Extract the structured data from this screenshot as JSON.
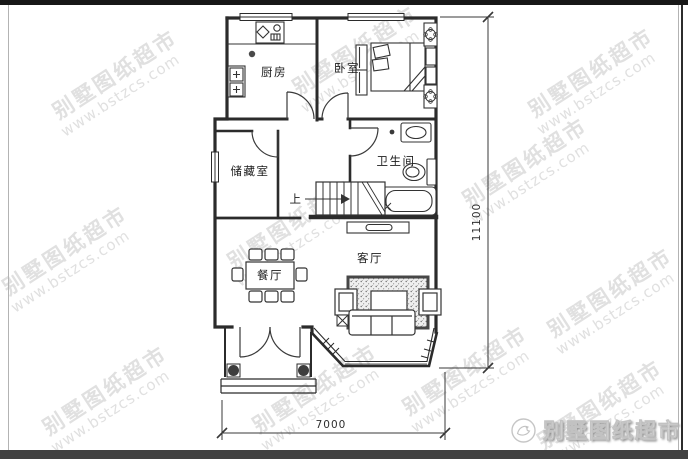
{
  "watermark": {
    "line1": "别墅图纸超市",
    "line2": "www.bstzcs.com"
  },
  "logo": {
    "text": "别墅图纸超市"
  },
  "plan": {
    "rooms": {
      "kitchen": "厨房",
      "bedroom": "卧室",
      "storage": "储藏室",
      "bathroom": "卫生间",
      "dining": "餐厅",
      "living": "客厅"
    },
    "stairs": {
      "up_label": "上"
    },
    "dimensions": {
      "depth": "11100",
      "width": "7000"
    }
  },
  "colors": {
    "wall": "#2b2b2b",
    "watermark": "#c7c7c7",
    "bottom_bar": "#414141"
  }
}
